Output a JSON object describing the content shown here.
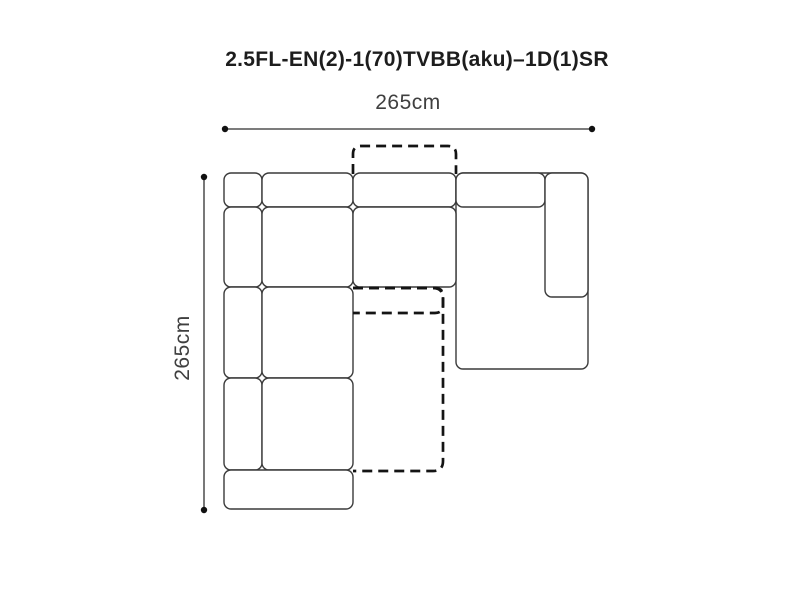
{
  "title": "2.5FL-EN(2)-1(70)TVBB(aku)–1D(1)SR",
  "dimensions": {
    "width": {
      "label": "265cm",
      "value_cm": 265
    },
    "depth": {
      "label": "265cm",
      "value_cm": 265
    }
  },
  "colors": {
    "background": "#ffffff",
    "module_outline": "#3a3a3a",
    "module_fill": "#ffffff",
    "dashed_outline": "#141414",
    "dimension_line": "#2f2f2f",
    "dimension_dot": "#111111",
    "title_text": "#1d1d1d",
    "dimension_text": "#3f3f3f"
  },
  "style": {
    "module_stroke_width": 1.4,
    "module_corner_radius": 7,
    "dashed_stroke_width": 2.7,
    "dash_pattern": "10 6",
    "dimension_stroke_width": 1.3,
    "endpoint_radius": 3.2
  },
  "diagram": {
    "dimension_lines": [
      {
        "name": "width-dimension-line",
        "x1": 225,
        "y1": 129,
        "x2": 592,
        "y2": 129
      },
      {
        "name": "depth-dimension-line",
        "x1": 204,
        "y1": 177,
        "x2": 204,
        "y2": 510
      }
    ],
    "modules": [
      {
        "name": "left-armrest-top",
        "x": 224,
        "y": 173,
        "w": 38,
        "h": 34
      },
      {
        "name": "back-cushion-left",
        "x": 262,
        "y": 173,
        "w": 91,
        "h": 34
      },
      {
        "name": "back-cushion-middle",
        "x": 353,
        "y": 173,
        "w": 103,
        "h": 34
      },
      {
        "name": "right-chaise-body",
        "x": 456,
        "y": 173,
        "w": 132,
        "h": 196
      },
      {
        "name": "back-cushion-right",
        "x": 456,
        "y": 173,
        "w": 89,
        "h": 34
      },
      {
        "name": "right-armrest",
        "x": 545,
        "y": 173,
        "w": 43,
        "h": 124
      },
      {
        "name": "left-armrest-mid-1",
        "x": 224,
        "y": 207,
        "w": 38,
        "h": 80
      },
      {
        "name": "seat-left-1",
        "x": 262,
        "y": 207,
        "w": 91,
        "h": 80
      },
      {
        "name": "seat-middle",
        "x": 353,
        "y": 207,
        "w": 103,
        "h": 80
      },
      {
        "name": "left-armrest-mid-2",
        "x": 224,
        "y": 287,
        "w": 38,
        "h": 91
      },
      {
        "name": "seat-left-2",
        "x": 262,
        "y": 287,
        "w": 91,
        "h": 91
      },
      {
        "name": "left-armrest-bottom",
        "x": 224,
        "y": 378,
        "w": 38,
        "h": 92
      },
      {
        "name": "seat-left-3",
        "x": 262,
        "y": 378,
        "w": 91,
        "h": 92
      },
      {
        "name": "front-rail",
        "x": 224,
        "y": 470,
        "w": 129,
        "h": 39
      }
    ],
    "dashed_shapes": [
      {
        "name": "bed-backrest-extension",
        "open": "bottom",
        "layer": "under",
        "x": 353,
        "y": 146,
        "w": 103,
        "h": 28,
        "r": 8
      },
      {
        "name": "bed-pullout-extension",
        "open": "left",
        "layer": "over",
        "x": 353,
        "y": 288,
        "w": 90,
        "h": 183,
        "r": 10
      },
      {
        "name": "bed-fold-section",
        "open": "left",
        "layer": "over",
        "x": 353,
        "y": 288,
        "w": 90,
        "h": 25,
        "r": 8
      }
    ]
  }
}
